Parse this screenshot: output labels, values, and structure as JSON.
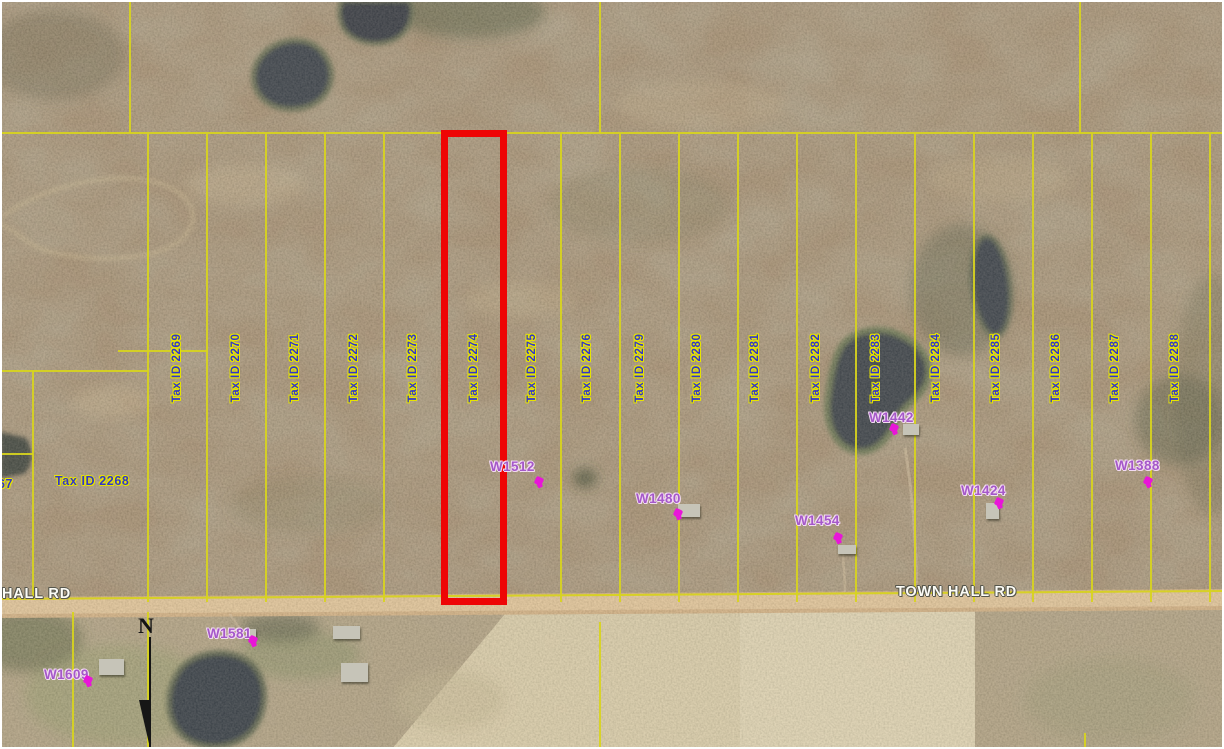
{
  "colors": {
    "parcel_line": "#d8d41e",
    "highlight_outline": "#ee0505",
    "tax_label_text": "#3137c9",
    "tax_label_halo": "#e6e400",
    "address_text": "#a558c9",
    "address_halo": "#f2daf2",
    "address_marker": "#e816d8",
    "road_label_text": "#fbfbf5",
    "road_label_halo": "#56564c"
  },
  "north_arrow": {
    "label": "N"
  },
  "corner_label": "67",
  "parcel_2268_label": "Tax ID 2268",
  "parcel_labels": [
    {
      "text": "Tax ID 2269",
      "cx": 177,
      "cy": 368
    },
    {
      "text": "Tax ID 2270",
      "cx": 236,
      "cy": 368
    },
    {
      "text": "Tax ID 2271",
      "cx": 295,
      "cy": 368
    },
    {
      "text": "Tax ID 2272",
      "cx": 354,
      "cy": 368
    },
    {
      "text": "Tax ID 2273",
      "cx": 413,
      "cy": 368
    },
    {
      "text": "Tax ID 2274",
      "cx": 474,
      "cy": 368,
      "highlighted": true
    },
    {
      "text": "Tax ID 2275",
      "cx": 532,
      "cy": 368
    },
    {
      "text": "Tax ID 2276",
      "cx": 587,
      "cy": 368
    },
    {
      "text": "Tax ID 2279",
      "cx": 640,
      "cy": 368
    },
    {
      "text": "Tax ID 2280",
      "cx": 697,
      "cy": 368
    },
    {
      "text": "Tax ID 2281",
      "cx": 755,
      "cy": 368
    },
    {
      "text": "Tax ID 2282",
      "cx": 816,
      "cy": 368
    },
    {
      "text": "Tax ID 2283",
      "cx": 876,
      "cy": 368
    },
    {
      "text": "Tax ID 2284",
      "cx": 936,
      "cy": 368
    },
    {
      "text": "Tax ID 2285",
      "cx": 996,
      "cy": 368
    },
    {
      "text": "Tax ID 2286",
      "cx": 1056,
      "cy": 368
    },
    {
      "text": "Tax ID 2287",
      "cx": 1115,
      "cy": 368
    },
    {
      "text": "Tax ID 2288",
      "cx": 1175,
      "cy": 368
    }
  ],
  "address_labels": [
    {
      "text": "W1512",
      "x": 490,
      "y": 459,
      "mx": 535,
      "my": 477
    },
    {
      "text": "W1480",
      "x": 636,
      "y": 491,
      "mx": 674,
      "my": 509
    },
    {
      "text": "W1454",
      "x": 795,
      "y": 513,
      "mx": 834,
      "my": 533
    },
    {
      "text": "W1442",
      "x": 869,
      "y": 410,
      "mx": 890,
      "my": 424
    },
    {
      "text": "W1424",
      "x": 961,
      "y": 483,
      "mx": 995,
      "my": 498
    },
    {
      "text": "W1388",
      "x": 1115,
      "y": 458,
      "mx": 1144,
      "my": 477
    },
    {
      "text": "W1581",
      "x": 207,
      "y": 626,
      "mx": 249,
      "my": 636
    },
    {
      "text": "W1609",
      "x": 44,
      "y": 667,
      "mx": 84,
      "my": 676
    }
  ],
  "road_labels": [
    {
      "text": "HALL RD",
      "x": 2,
      "y": 586
    },
    {
      "text": "TOWN HALL RD",
      "x": 896,
      "y": 584
    }
  ],
  "geometry": {
    "highlight_rect": {
      "left": 441,
      "top": 130,
      "width": 66,
      "height": 475,
      "border": 7
    },
    "parcel_lines": [
      [
        148,
        134,
        148,
        602
      ],
      [
        207,
        134,
        207,
        602
      ],
      [
        266,
        134,
        266,
        602
      ],
      [
        325,
        134,
        325,
        602
      ],
      [
        384,
        134,
        384,
        602
      ],
      [
        443,
        134,
        443,
        602
      ],
      [
        506,
        134,
        506,
        602
      ],
      [
        561,
        134,
        561,
        602
      ],
      [
        620,
        134,
        620,
        602
      ],
      [
        679,
        134,
        679,
        602
      ],
      [
        738,
        134,
        738,
        602
      ],
      [
        797,
        134,
        797,
        602
      ],
      [
        856,
        134,
        856,
        602
      ],
      [
        915,
        134,
        915,
        602
      ],
      [
        974,
        134,
        974,
        602
      ],
      [
        1033,
        134,
        1033,
        602
      ],
      [
        1092,
        134,
        1092,
        602
      ],
      [
        1151,
        134,
        1151,
        602
      ],
      [
        1210,
        134,
        1210,
        602
      ],
      [
        130,
        0,
        130,
        133
      ],
      [
        600,
        0,
        600,
        133
      ],
      [
        1080,
        0,
        1080,
        133
      ],
      [
        0,
        133,
        1224,
        133
      ],
      [
        0,
        371,
        148,
        371
      ],
      [
        118,
        351,
        208,
        351
      ],
      [
        0,
        454,
        33,
        454
      ],
      [
        33,
        371,
        33,
        600
      ],
      [
        0,
        599,
        1224,
        591
      ],
      [
        73,
        612,
        73,
        749
      ],
      [
        148,
        612,
        148,
        749
      ],
      [
        600,
        622,
        600,
        749
      ],
      [
        1085,
        733,
        1085,
        749
      ]
    ],
    "buildings": [
      [
        903,
        424,
        16,
        11
      ],
      [
        678,
        504,
        22,
        13
      ],
      [
        986,
        503,
        13,
        16
      ],
      [
        838,
        545,
        18,
        9
      ],
      [
        333,
        626,
        27,
        13
      ],
      [
        341,
        663,
        27,
        19
      ],
      [
        99,
        659,
        25,
        16
      ],
      [
        246,
        629,
        10,
        8
      ]
    ]
  }
}
